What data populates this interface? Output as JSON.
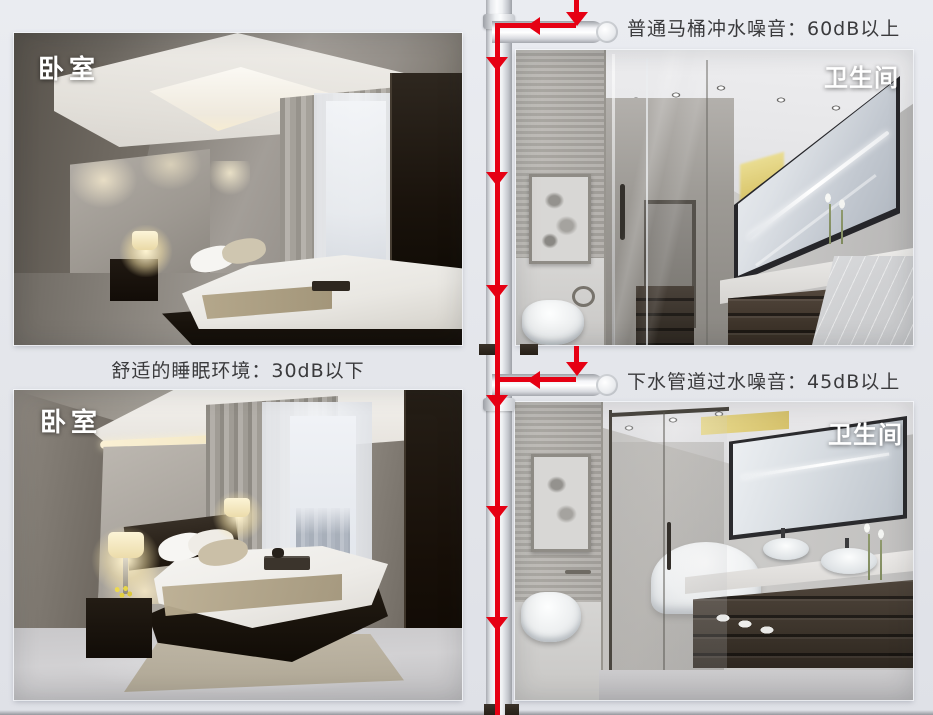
{
  "colors": {
    "background": "#e5e7ec",
    "flow_line_red": "#e60013",
    "pipe_white": "#f2f3f6",
    "caption_text": "#3a3a3c",
    "room_label_text": "#ffffff"
  },
  "rooms": {
    "bedroom_top": {
      "label": "卧室"
    },
    "bathroom_top": {
      "label": "卫生间"
    },
    "bedroom_bottom": {
      "label": "卧室"
    },
    "bathroom_bottom": {
      "label": "卫生间"
    }
  },
  "captions": {
    "toilet_flush_noise": "普通马桶冲水噪音：60dB以上",
    "sleep_environment": "舒适的睡眠环境：30dB以下",
    "drain_pipe_noise": "下水管道过水噪音：45dB以上"
  },
  "icons": {
    "flow_arrow_down": "red downward triangle (water flow direction)",
    "flow_arrow_left": "red leftward triangle (water flow direction)"
  }
}
